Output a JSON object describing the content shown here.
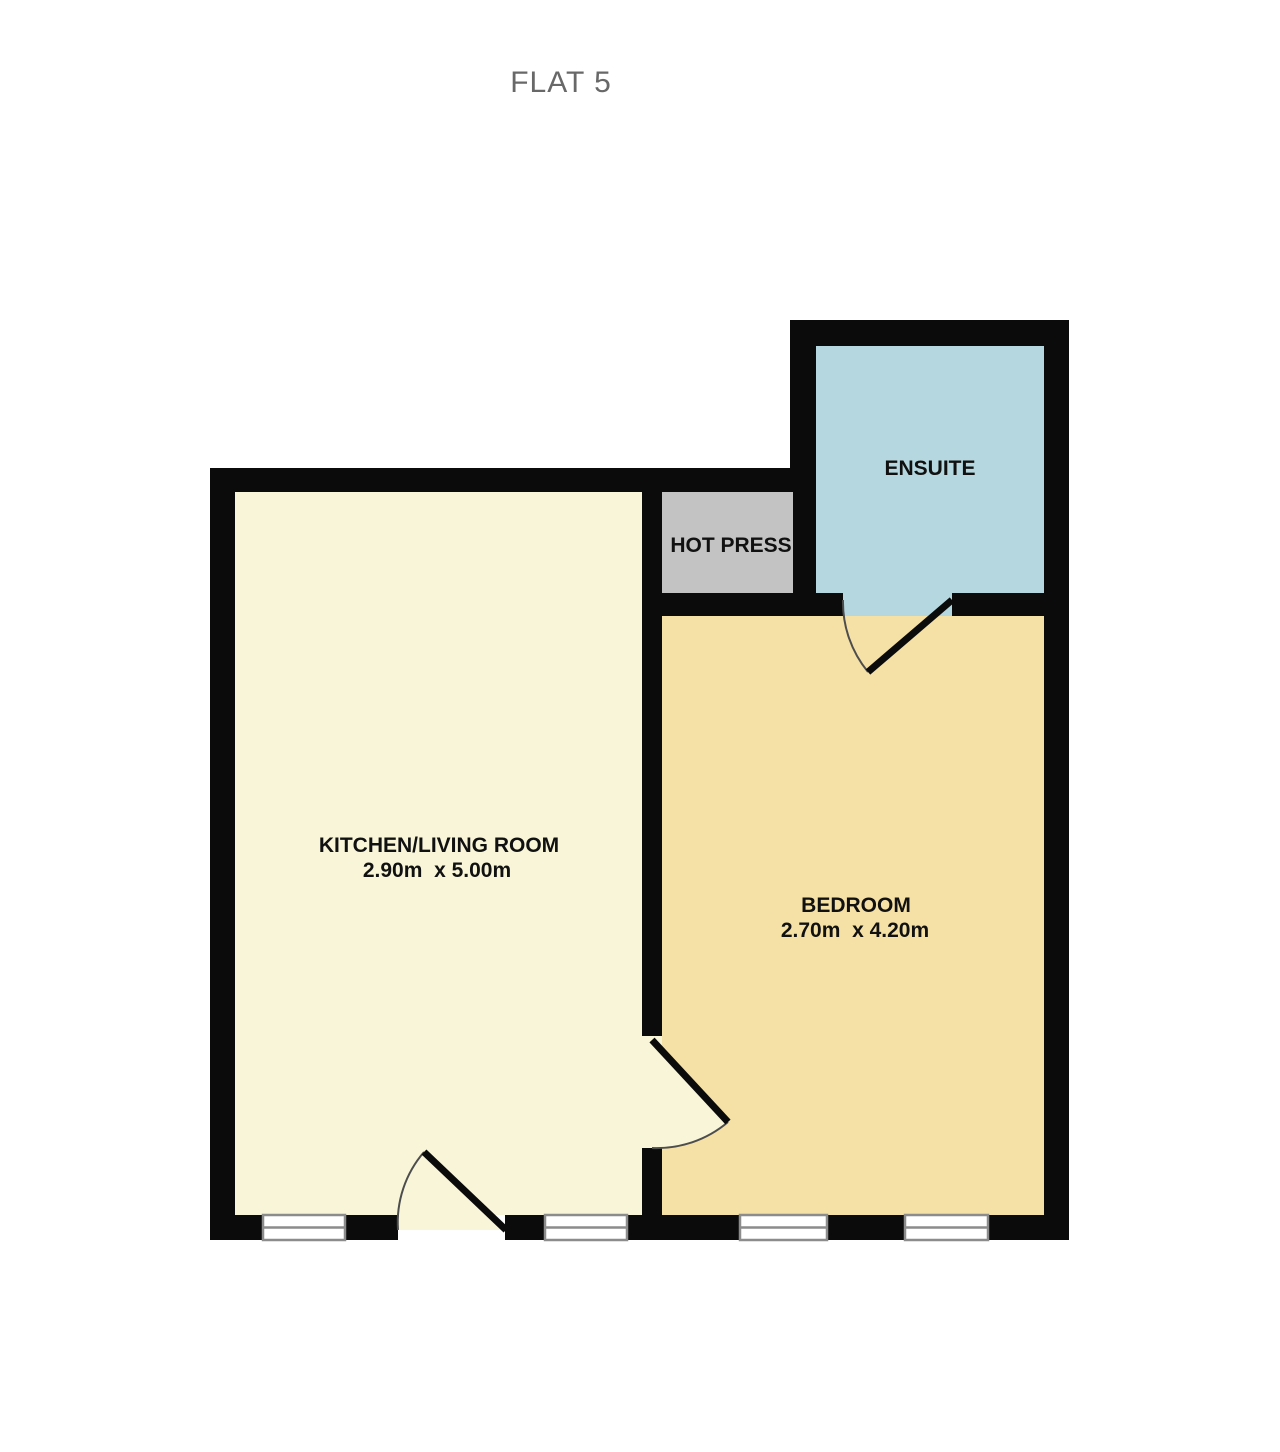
{
  "title": "FLAT 5",
  "rooms": {
    "kitchen": {
      "label": "KITCHEN/LIVING ROOM",
      "dimensions": "2.90m  x 5.00m",
      "color": "#f9f5d9"
    },
    "bedroom": {
      "label": "BEDROOM",
      "dimensions": "2.70m  x 4.20m",
      "color": "#f5e1a5"
    },
    "ensuite": {
      "label": "ENSUITE",
      "color": "#b5d8e0"
    },
    "hot_press": {
      "label": "HOT PRESS",
      "color": "#c3c3c3"
    }
  },
  "colors": {
    "wall": "#0b0b0b",
    "background": "#ffffff",
    "window_frame": "#8c8c8c",
    "window_fill": "#ffffff",
    "door_arc": "#4d4d4d",
    "door_leaf": "#0b0b0b",
    "title_text": "#686868",
    "label_text": "#111111"
  }
}
